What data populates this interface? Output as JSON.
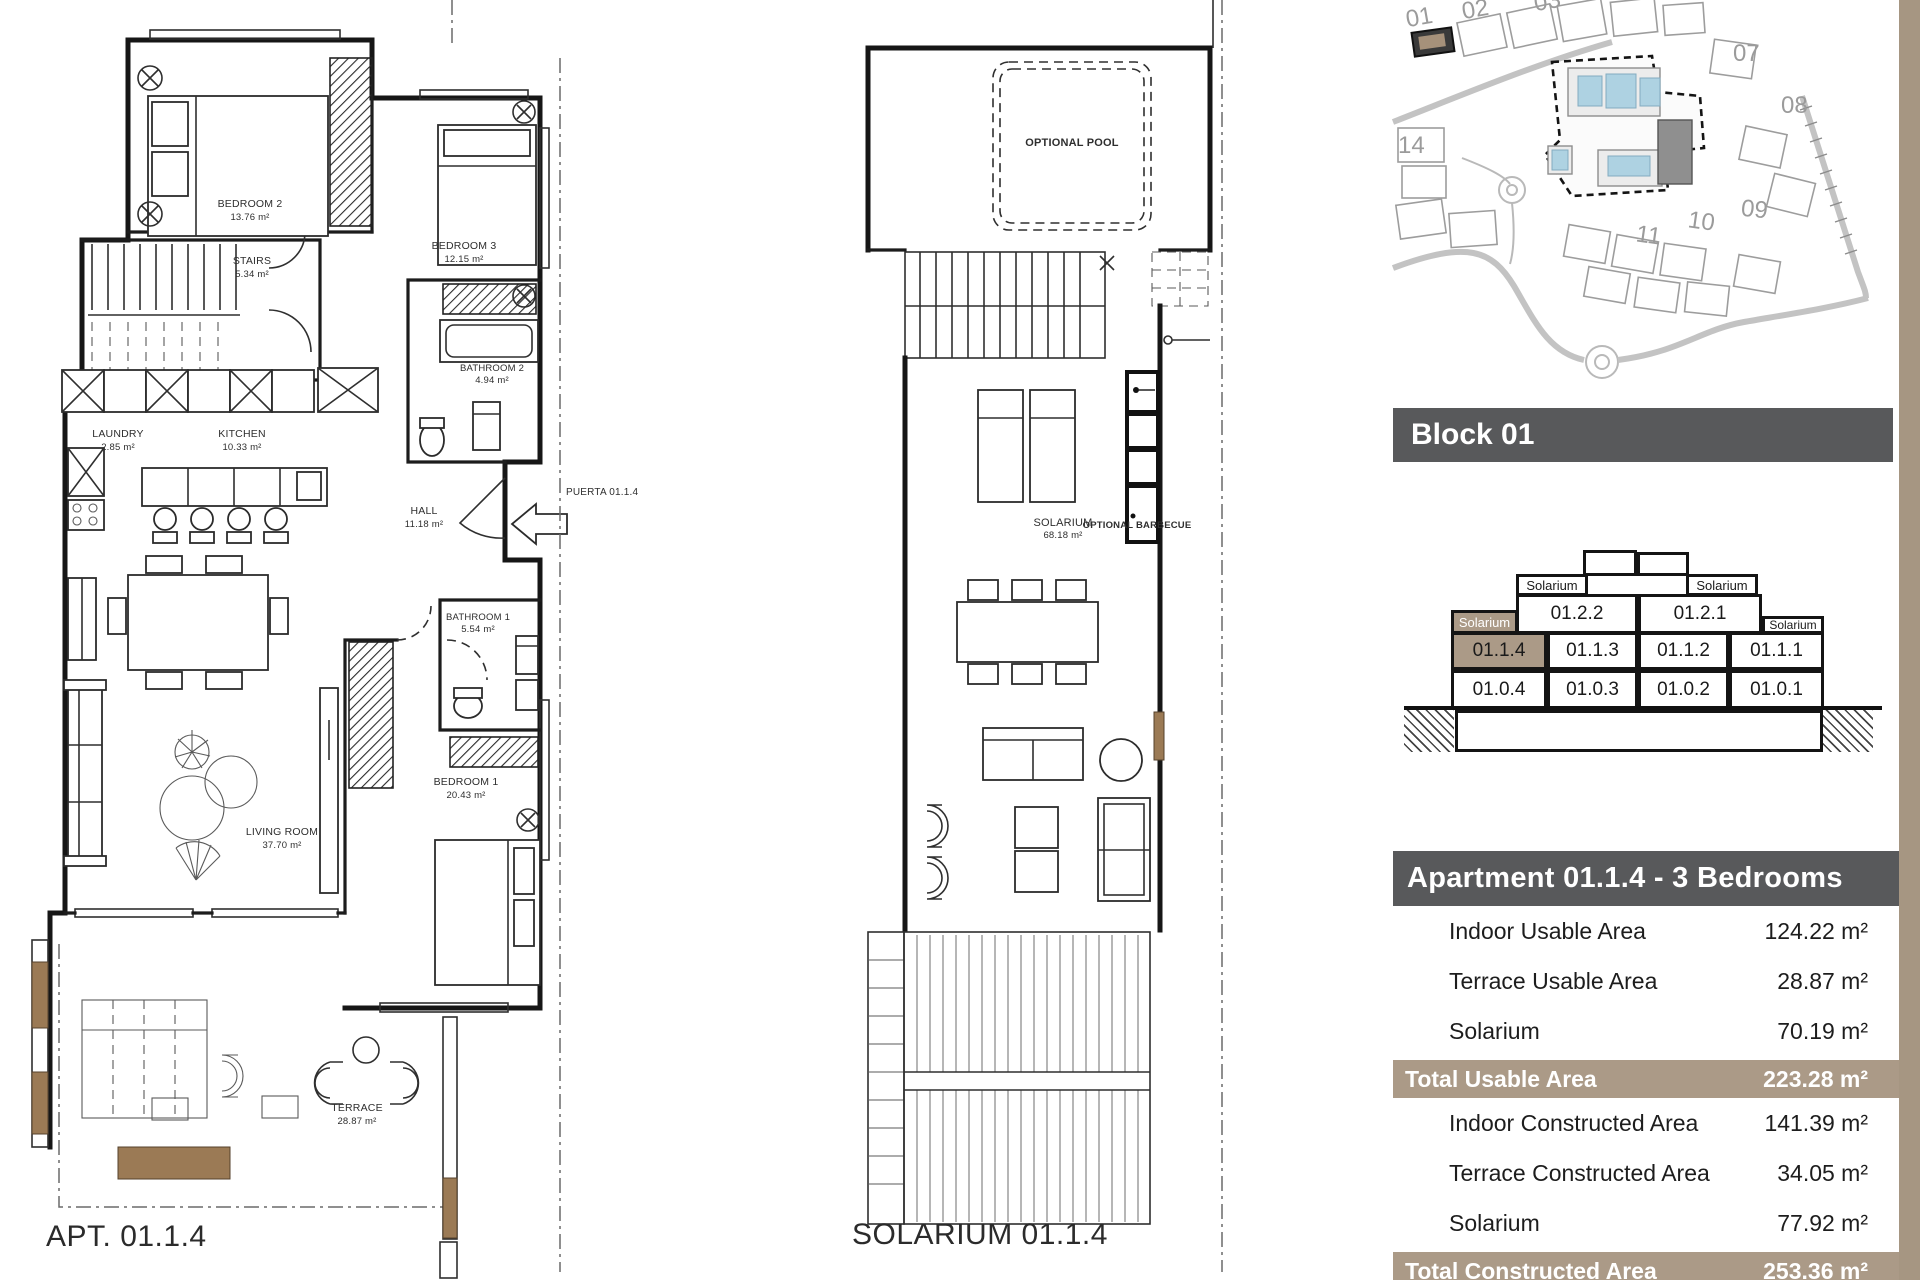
{
  "left_plan": {
    "caption": "APT. 01.1.4",
    "entry_label": "PUERTA 01.1.4",
    "rooms": {
      "bedroom2": {
        "name": "BEDROOM 2",
        "area": "13.76 m²"
      },
      "stairs": {
        "name": "STAIRS",
        "area": "5.34 m²"
      },
      "bedroom3": {
        "name": "BEDROOM 3",
        "area": "12.15 m²"
      },
      "bathroom2": {
        "name": "BATHROOM 2",
        "area": "4.94 m²"
      },
      "laundry": {
        "name": "LAUNDRY",
        "area": "2.85 m²"
      },
      "kitchen": {
        "name": "KITCHEN",
        "area": "10.33 m²"
      },
      "hall": {
        "name": "HALL",
        "area": "11.18 m²"
      },
      "bathroom1": {
        "name": "BATHROOM 1",
        "area": "5.54 m²"
      },
      "bedroom1": {
        "name": "BEDROOM 1",
        "area": "20.43 m²"
      },
      "living": {
        "name": "LIVING ROOM",
        "area": "37.70 m²"
      },
      "terrace": {
        "name": "TERRACE",
        "area": "28.87 m²"
      }
    }
  },
  "solarium_plan": {
    "caption": "SOLARIUM 01.1.4",
    "pool_label": "OPTIONAL POOL",
    "solarium": {
      "name": "SOLARIUM",
      "area": "68.18 m²"
    },
    "barbecue_line1": "OPTIONAL",
    "barbecue_line2": "BARBECUE"
  },
  "site_map": {
    "numbers": [
      "01",
      "02",
      "03",
      "07",
      "08",
      "14",
      "09",
      "10",
      "11"
    ]
  },
  "block_section": {
    "title": "Block 01",
    "solarium_label": "Solarium",
    "floor2": [
      "01.2.2",
      "01.2.1"
    ],
    "floor1": [
      "01.1.4",
      "01.1.3",
      "01.1.2",
      "01.1.1"
    ],
    "floor0": [
      "01.0.4",
      "01.0.3",
      "01.0.2",
      "01.0.1"
    ]
  },
  "apartment_panel": {
    "title": "Apartment 01.1.4 - 3 Bedrooms",
    "rows": [
      {
        "label": "Indoor Usable Area",
        "value": "124.22 m²"
      },
      {
        "label": "Terrace Usable Area",
        "value": "28.87 m²"
      },
      {
        "label": "Solarium",
        "value": "70.19 m²"
      },
      {
        "label": "Total Usable Area",
        "value": "223.28 m²"
      },
      {
        "label": "Indoor Constructed Area",
        "value": "141.39 m²"
      },
      {
        "label": "Terrace Constructed Area",
        "value": "34.05 m²"
      },
      {
        "label": "Solarium",
        "value": "77.92 m²"
      },
      {
        "label": "Total Constructed Area",
        "value": "253.36 m²"
      }
    ]
  },
  "colors": {
    "header_gray": "#58595b",
    "tan": "#ab9a87",
    "pool_blue": "#aed2e2"
  }
}
